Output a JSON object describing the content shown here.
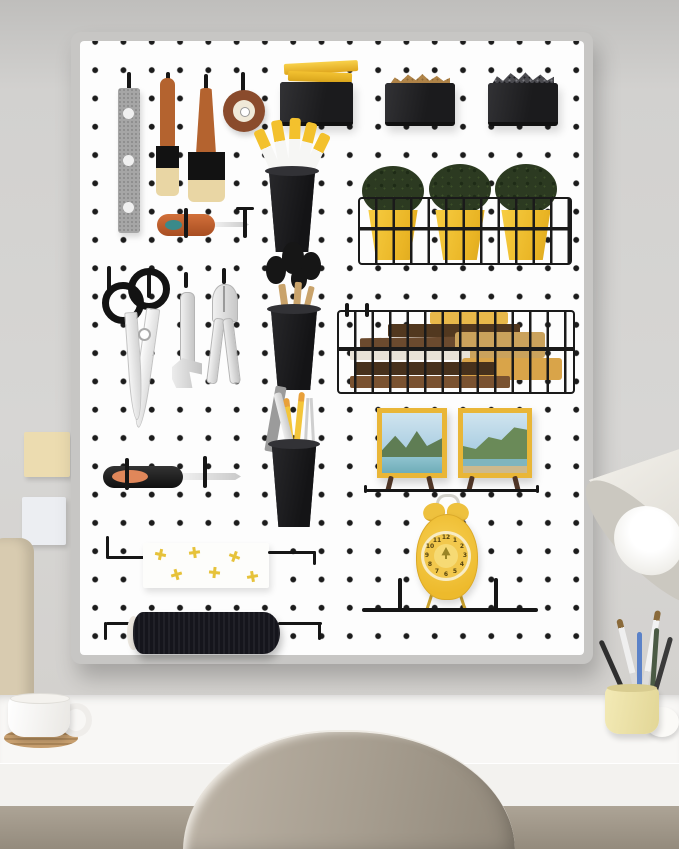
{
  "meta": {
    "scene_label": "White pegboard organizer panel with tools, planters, frames and clock, mounted on a gray wall above a white desk with a shell chair"
  },
  "palette": {
    "pegboard_panel": "#fdfdfd",
    "pegboard_frame": "#c7c6c4",
    "peg_dot": "#1c1c1c",
    "black_bin": "#212123",
    "cup_black": "#1e1e20",
    "accent_yellow": "#f0c232",
    "plant_green": "#2c3a21",
    "frame_yellow": "#e9b637",
    "clock_yellow": "#f2c84d",
    "steel_gray": "#a6a6a6",
    "wood_brown": "#b4632f",
    "bristle_tan": "#e9d6a4",
    "tape_brown": "#8a4b2c",
    "desk_white": "#f8f7f5",
    "desk_front": "#f3f2ef",
    "under_desk": "#a49b8f",
    "chair_taupe": "#a69d8f",
    "mug_white": "#fbfaf8",
    "coaster_wood": "#c79f6f",
    "note_cream": "#ecdcb0",
    "note_white": "#eceef2",
    "spool_black": "#15151c",
    "lamp_shade": "#e9e6e0",
    "cup_pale_yellow": "#efe5ad",
    "pencil_blue": "#5b82c8",
    "beige_object": "#d8cbb0",
    "wall_gray": "#d6d5d3"
  },
  "pegboard": {
    "clock": {
      "numerals": [
        "12",
        "1",
        "2",
        "3",
        "4",
        "5",
        "6",
        "7",
        "8",
        "9",
        "10",
        "11"
      ]
    },
    "inventory": [
      "metal ruler strip",
      "small paint brush",
      "large paint brush",
      "tape roll",
      "awl screwdriver",
      "storage bin with yellow blocks",
      "storage bin with brass screws",
      "storage bin with black screws",
      "tool cup with yellow-handle tools",
      "wire planter basket",
      "yellow plant pots",
      "scissors",
      "adjustable wrench",
      "pliers",
      "cup with round brushes",
      "wire book basket",
      "books",
      "cup with pencils and ruler",
      "framed landscape photo",
      "framed landscape photo",
      "black screwdriver",
      "towel with yellow crosses",
      "yellow alarm clock",
      "black wire rail shelf",
      "black thread spool"
    ]
  },
  "room": {
    "inventory": [
      "cream sticky note",
      "white sticky note",
      "beige side object",
      "white desk",
      "white mug",
      "wood coaster",
      "taupe shell chair",
      "white desk lamp",
      "pale yellow brush cup",
      "paint brushes",
      "blue pencil",
      "white round jar"
    ]
  }
}
